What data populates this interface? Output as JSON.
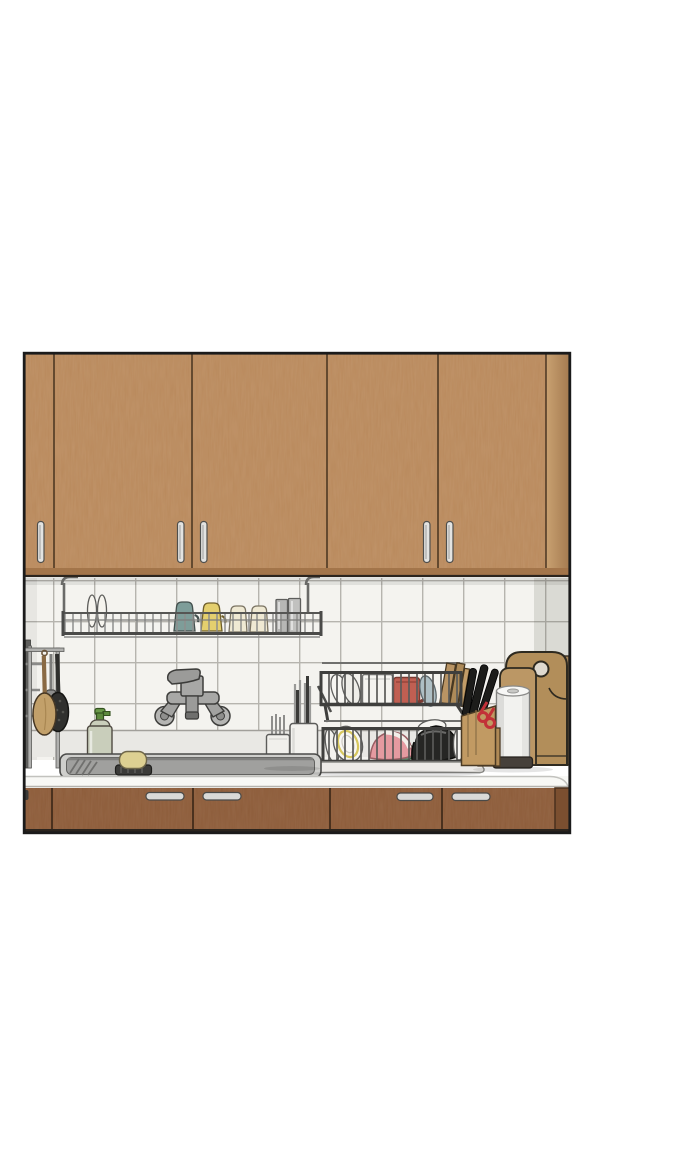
{
  "scene": {
    "type": "illustration",
    "description": "Comic-style drawing of a kitchen wall: wooden upper cabinets, white tile backsplash, wall-mounted faucet, sink counter with dish racks and utensils, wooden lower cabinets, framed as a rectangular manga panel on a white page",
    "objects": [
      {
        "name": "upper-cabinets",
        "color": "#b9895c",
        "doors": 5,
        "handles": "vertical silver bars"
      },
      {
        "name": "under-cabinet-hanging-rack",
        "color": "#8c8c8a",
        "contents": [
          "two plates",
          "teal cup",
          "yellow cup",
          "two cream cups",
          "two gray tumblers"
        ]
      },
      {
        "name": "tile-backsplash",
        "color": "#f4f3ef",
        "tile_size_px": 41
      },
      {
        "name": "left-utensil-rack",
        "contents": [
          "wooden spoon",
          "black skimmer",
          "gray spatula"
        ]
      },
      {
        "name": "soap-dispenser",
        "bottle_color": "#c9cebb",
        "pump_color": "#5d8a3e"
      },
      {
        "name": "wall-faucet",
        "color": "#a7a7a5"
      },
      {
        "name": "sink",
        "basin_color": "#a0a09e"
      },
      {
        "name": "soap-bar-on-dish",
        "soap_color": "#ddd092",
        "dish_color": "#3b3b39"
      },
      {
        "name": "cutlery-holders",
        "color": "#f1f0ec",
        "contents": [
          "chopsticks",
          "dark-handled tools"
        ]
      },
      {
        "name": "two-tier-dish-rack",
        "wire_color": "#4e4e4c",
        "top_tier": [
          "white plates",
          "white container",
          "red mug",
          "blue-gray plate",
          "small wooden boards"
        ],
        "bottom_tier": [
          "white bowl with yellow stripe",
          "pink bowl",
          "green plate",
          "black pot",
          "white plates"
        ]
      },
      {
        "name": "knife-block",
        "color": "#c19a63",
        "contents": [
          "three black knives",
          "red scissors"
        ]
      },
      {
        "name": "paper-towel-roll",
        "color": "#f2f2ef",
        "base_color": "#46403a"
      },
      {
        "name": "cutting-boards",
        "color": "#b28e5a",
        "count": 3,
        "feature": "round handle hole"
      },
      {
        "name": "counter",
        "color": "#f8f8f5"
      },
      {
        "name": "lower-cabinets",
        "color": "#8d5c3a",
        "doors": 5,
        "handles": "horizontal silver bars"
      },
      {
        "name": "panel-frame",
        "color": "#1b1b1b"
      }
    ]
  },
  "palette": {
    "upper_cabinet": "#b9895c",
    "upper_cabinet_side": "#c79c6d",
    "lower_cabinet": "#8d5c3a",
    "lower_cabinet_side": "#7b4f30",
    "tile": "#f4f3ef",
    "grout": "#b6b4ae",
    "ledge": "#e9e8e4",
    "counter": "#f8f8f5",
    "sink_basin": "#a0a09e",
    "sink_rim": "#cfcfcc",
    "metal": "#a7a7a5",
    "wire_dark": "#5a5a58",
    "wire_light": "#87878a",
    "teal_cup": "#7e9d99",
    "yellow_cup": "#e4cf6e",
    "cream_cup": "#efe9d3",
    "tumbler": "#b7b7b5",
    "red_mug": "#c05f52",
    "pink_bowl": "#e59aa0",
    "green_plate": "#5f8f6f",
    "black_bowl": "#262624",
    "wood_board": "#b28e5a",
    "knife_block": "#c19a63",
    "scissors_red": "#c23238",
    "soap_bottle": "#c9cebb",
    "soap_green": "#5d8a3e",
    "soap_bar": "#ddd092",
    "frame": "#1b1b1b",
    "white_dish": "#f7f6f2"
  }
}
